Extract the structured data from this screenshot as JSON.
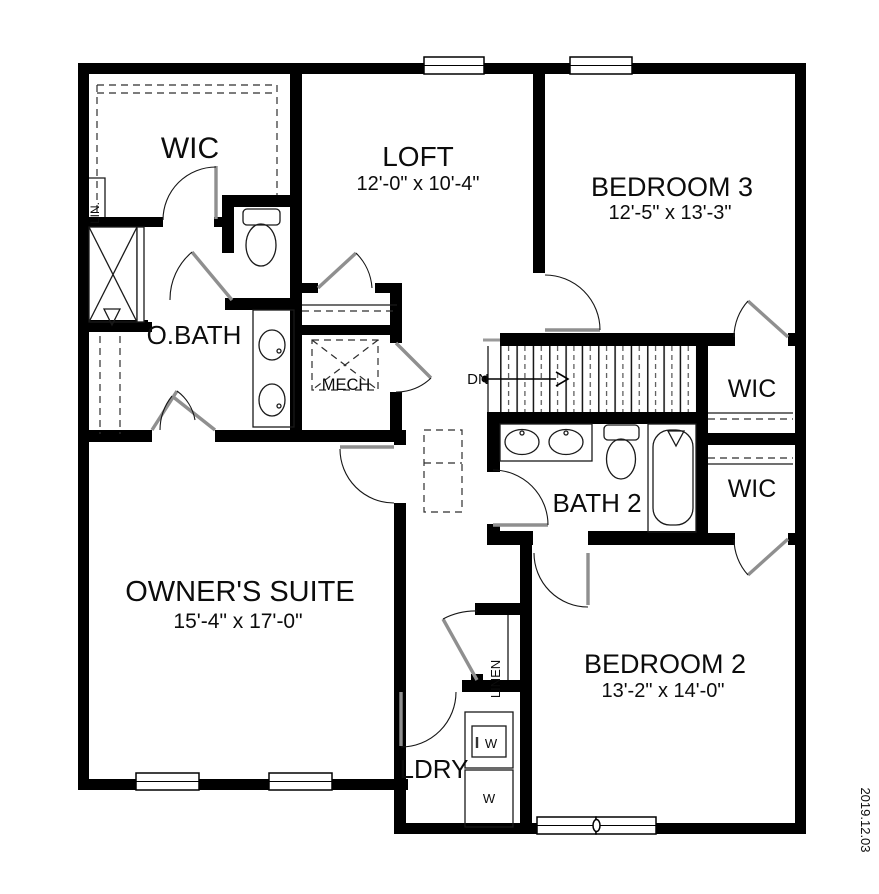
{
  "meta": {
    "title": "Second floor plan",
    "date_stamp": "2019.12.03"
  },
  "colors": {
    "wall": "#000000",
    "door_leaf": "#8f8f8f",
    "background": "#ffffff",
    "text": "#0c0c0c"
  },
  "labels": {
    "wic_upper": "WIC",
    "loft": "LOFT",
    "loft_dims": "12'-0\" x 10'-4\"",
    "bedroom3": "BEDROOM 3",
    "bedroom3_dims": "12'-5\" x 13'-3\"",
    "lin_closet": "LIN.",
    "owners_bath": "O.BATH",
    "mech": "MECH",
    "stairs_down": "DN",
    "wic_right_upper": "WIC",
    "wic_right_lower": "WIC",
    "bath2": "BATH 2",
    "owners_suite": "OWNER'S SUITE",
    "owners_suite_dims": "15'-4\" x 17'-0\"",
    "bedroom2": "BEDROOM 2",
    "bedroom2_dims": "13'-2\" x 14'-0\"",
    "linen": "LINEN",
    "laundry": "LDRY",
    "washer": "W",
    "dryer": "W",
    "date_stamp": "2019.12.03"
  }
}
